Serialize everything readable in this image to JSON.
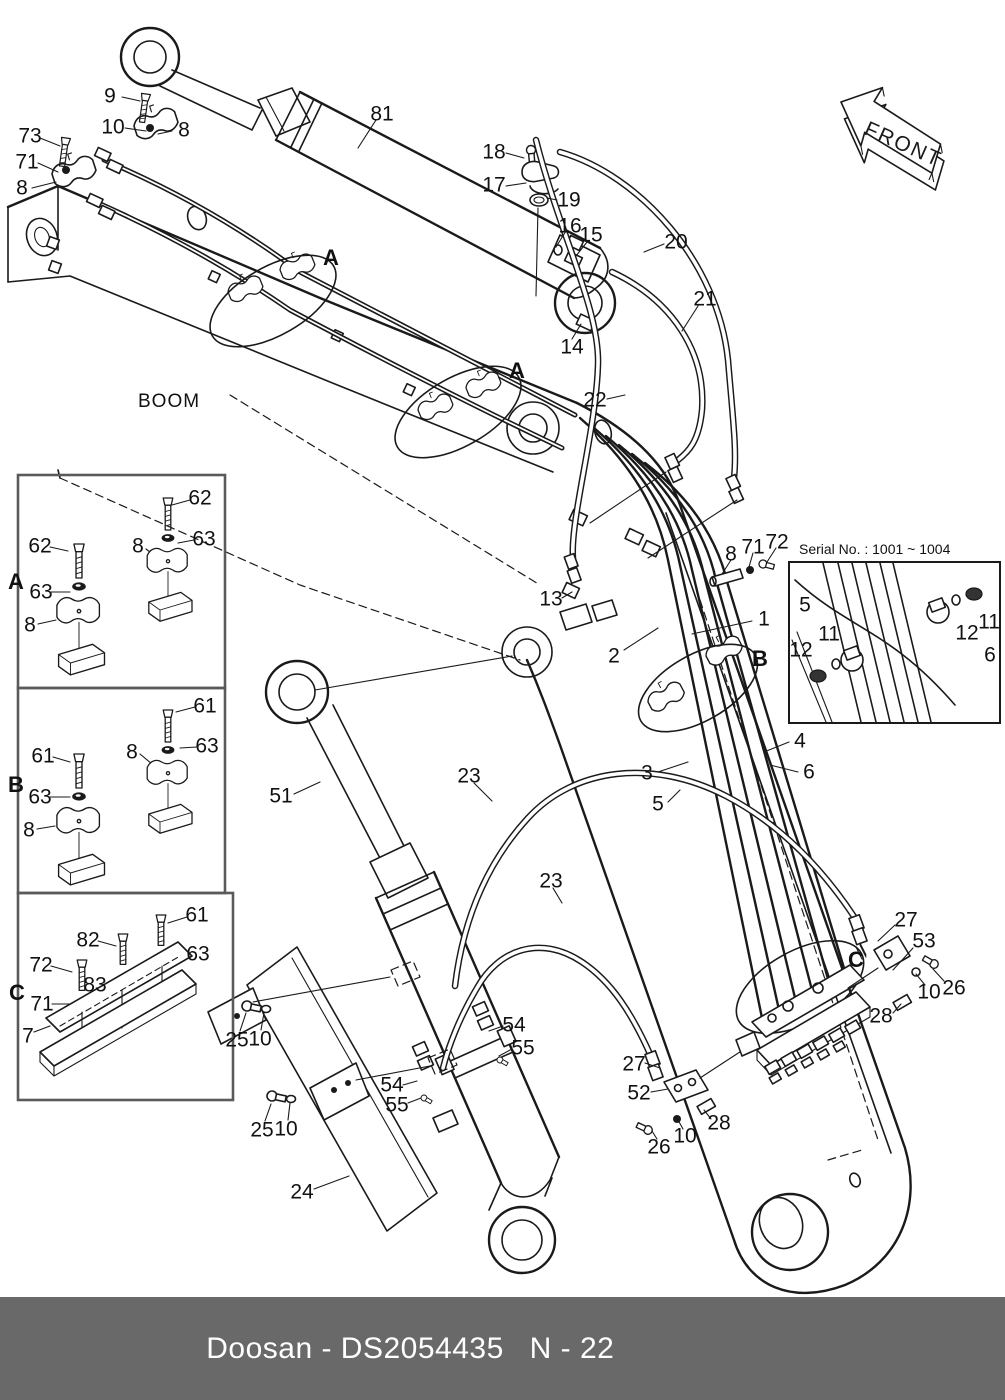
{
  "footer": {
    "left_text": "Doosan - DS2054435",
    "right_text": "N - 22",
    "bg_color": "#696969",
    "fg_color": "#ffffff"
  },
  "diagram": {
    "boom_label": "BOOM",
    "front_label": "FRONT",
    "serial_box_title": "Serial No. : 1001 ~ 1004",
    "line_color": "#1a1a1a",
    "detail_sections": [
      "A",
      "B",
      "C"
    ],
    "callouts": [
      {
        "label": "73",
        "x": 30,
        "y": 136
      },
      {
        "label": "71",
        "x": 27,
        "y": 162
      },
      {
        "label": "8",
        "x": 22,
        "y": 188
      },
      {
        "label": "9",
        "x": 110,
        "y": 96
      },
      {
        "label": "10",
        "x": 113,
        "y": 127
      },
      {
        "label": "8",
        "x": 184,
        "y": 130
      },
      {
        "label": "81",
        "x": 382,
        "y": 114
      },
      {
        "label": "18",
        "x": 494,
        "y": 152
      },
      {
        "label": "17",
        "x": 494,
        "y": 185
      },
      {
        "label": "19",
        "x": 569,
        "y": 200
      },
      {
        "label": "16",
        "x": 570,
        "y": 226
      },
      {
        "label": "15",
        "x": 591,
        "y": 235
      },
      {
        "label": "20",
        "x": 676,
        "y": 242
      },
      {
        "label": "21",
        "x": 705,
        "y": 299
      },
      {
        "label": "14",
        "x": 572,
        "y": 347
      },
      {
        "label": "22",
        "x": 595,
        "y": 400
      },
      {
        "label": "13",
        "x": 551,
        "y": 599
      },
      {
        "label": "2",
        "x": 614,
        "y": 656
      },
      {
        "label": "1",
        "x": 764,
        "y": 619
      },
      {
        "label": "8",
        "x": 731,
        "y": 554
      },
      {
        "label": "71",
        "x": 753,
        "y": 547
      },
      {
        "label": "72",
        "x": 777,
        "y": 542
      },
      {
        "label": "3",
        "x": 647,
        "y": 773
      },
      {
        "label": "4",
        "x": 800,
        "y": 741
      },
      {
        "label": "5",
        "x": 658,
        "y": 804
      },
      {
        "label": "6",
        "x": 809,
        "y": 772
      },
      {
        "label": "51",
        "x": 281,
        "y": 796
      },
      {
        "label": "23",
        "x": 469,
        "y": 776
      },
      {
        "label": "23",
        "x": 551,
        "y": 881
      },
      {
        "label": "27",
        "x": 906,
        "y": 920
      },
      {
        "label": "53",
        "x": 924,
        "y": 941
      },
      {
        "label": "10",
        "x": 929,
        "y": 992
      },
      {
        "label": "26",
        "x": 954,
        "y": 988
      },
      {
        "label": "28",
        "x": 881,
        "y": 1016
      },
      {
        "label": "27",
        "x": 634,
        "y": 1064
      },
      {
        "label": "52",
        "x": 639,
        "y": 1093
      },
      {
        "label": "28",
        "x": 719,
        "y": 1123
      },
      {
        "label": "10",
        "x": 685,
        "y": 1136
      },
      {
        "label": "26",
        "x": 659,
        "y": 1147
      },
      {
        "label": "54",
        "x": 514,
        "y": 1025
      },
      {
        "label": "55",
        "x": 523,
        "y": 1048
      },
      {
        "label": "54",
        "x": 392,
        "y": 1085
      },
      {
        "label": "55",
        "x": 397,
        "y": 1105
      },
      {
        "label": "25",
        "x": 237,
        "y": 1040
      },
      {
        "label": "10",
        "x": 260,
        "y": 1039
      },
      {
        "label": "25",
        "x": 262,
        "y": 1130
      },
      {
        "label": "10",
        "x": 286,
        "y": 1129
      },
      {
        "label": "24",
        "x": 302,
        "y": 1192
      },
      {
        "label": "62",
        "x": 200,
        "y": 498
      },
      {
        "label": "63",
        "x": 204,
        "y": 539
      },
      {
        "label": "8",
        "x": 138,
        "y": 546
      },
      {
        "label": "62",
        "x": 40,
        "y": 546
      },
      {
        "label": "63",
        "x": 41,
        "y": 592
      },
      {
        "label": "8",
        "x": 30,
        "y": 625
      },
      {
        "label": "61",
        "x": 205,
        "y": 706
      },
      {
        "label": "63",
        "x": 207,
        "y": 746
      },
      {
        "label": "8",
        "x": 132,
        "y": 752
      },
      {
        "label": "61",
        "x": 43,
        "y": 756
      },
      {
        "label": "63",
        "x": 40,
        "y": 797
      },
      {
        "label": "8",
        "x": 29,
        "y": 830
      },
      {
        "label": "61",
        "x": 197,
        "y": 915
      },
      {
        "label": "82",
        "x": 88,
        "y": 940
      },
      {
        "label": "63",
        "x": 198,
        "y": 954
      },
      {
        "label": "72",
        "x": 41,
        "y": 965
      },
      {
        "label": "83",
        "x": 95,
        "y": 985
      },
      {
        "label": "71",
        "x": 42,
        "y": 1004
      },
      {
        "label": "7",
        "x": 28,
        "y": 1036
      },
      {
        "label": "5",
        "x": 805,
        "y": 605
      },
      {
        "label": "11",
        "x": 829,
        "y": 634
      },
      {
        "label": "12",
        "x": 801,
        "y": 650
      },
      {
        "label": "12",
        "x": 967,
        "y": 633
      },
      {
        "label": "11",
        "x": 989,
        "y": 622
      },
      {
        "label": "6",
        "x": 990,
        "y": 655
      },
      {
        "label": "A",
        "x": 331,
        "y": 258,
        "kind": "marker"
      },
      {
        "label": "A",
        "x": 517,
        "y": 371,
        "kind": "marker"
      },
      {
        "label": "B",
        "x": 760,
        "y": 659,
        "kind": "marker"
      },
      {
        "label": "C",
        "x": 856,
        "y": 960,
        "kind": "marker"
      },
      {
        "label": "A",
        "x": 16,
        "y": 582,
        "kind": "marker"
      },
      {
        "label": "B",
        "x": 16,
        "y": 785,
        "kind": "marker"
      },
      {
        "label": "C",
        "x": 17,
        "y": 993,
        "kind": "marker"
      }
    ]
  }
}
